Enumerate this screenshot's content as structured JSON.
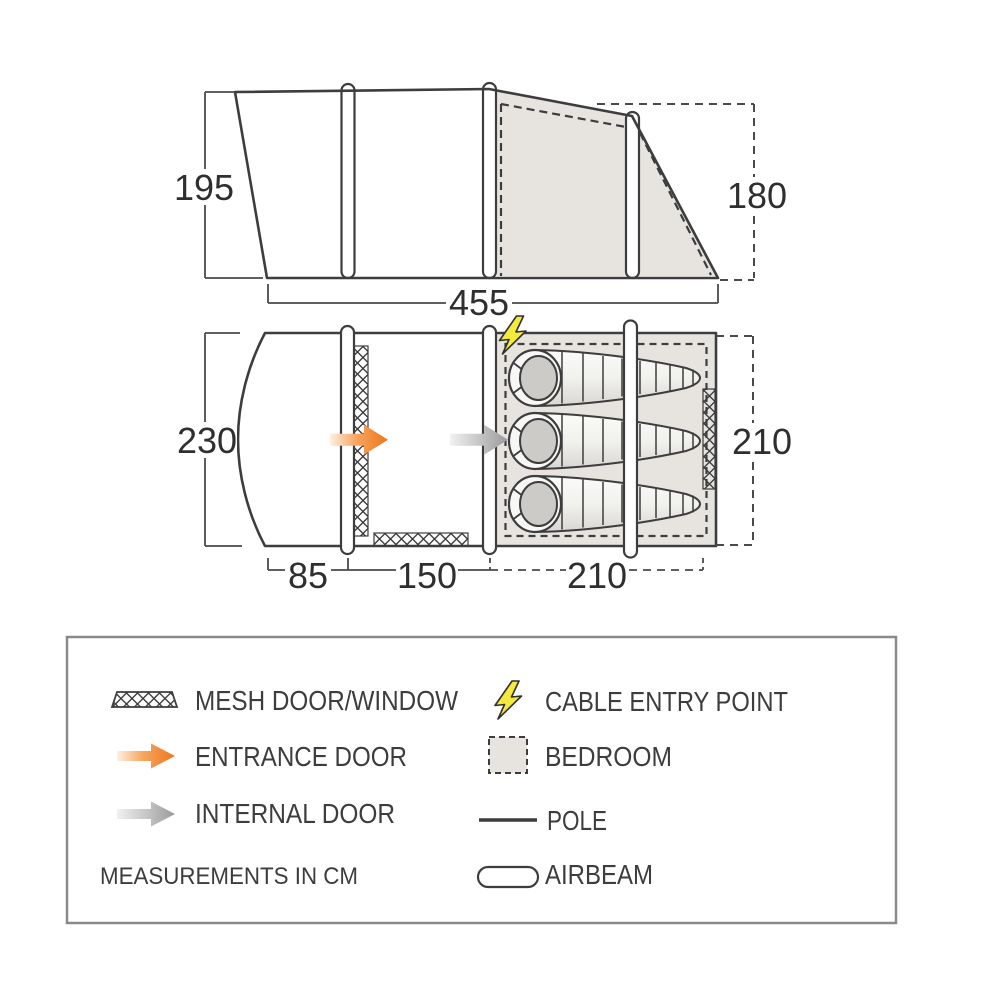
{
  "elevation": {
    "height_left_cm": "195",
    "height_right_cm": "180",
    "width_cm": "455"
  },
  "floorplan": {
    "width_left_cm": "230",
    "width_right_cm": "210",
    "length_porch_cm": "85",
    "length_living_cm": "150",
    "length_bedroom_cm": "210"
  },
  "legend": {
    "note": "MEASUREMENTS IN CM",
    "items": [
      {
        "icon": "mesh-pattern-icon",
        "label": "MESH DOOR/WINDOW"
      },
      {
        "icon": "entrance-arrow-icon",
        "label": "ENTRANCE DOOR"
      },
      {
        "icon": "internal-arrow-icon",
        "label": "INTERNAL DOOR"
      },
      {
        "icon": "lightning-bolt-icon",
        "label": "CABLE ENTRY POINT"
      },
      {
        "icon": "bedroom-swatch-icon",
        "label": "BEDROOM"
      },
      {
        "icon": "pole-line-icon",
        "label": "POLE"
      },
      {
        "icon": "airbeam-capsule-icon",
        "label": "AIRBEAM"
      }
    ]
  },
  "colors": {
    "line": "#3d3d3d",
    "bedroom_shade": "#e7e4e0",
    "entrance_orange": "#ed761c",
    "internal_gray": "#9a9a9a",
    "cable_yellow": "#f3ea3d"
  }
}
